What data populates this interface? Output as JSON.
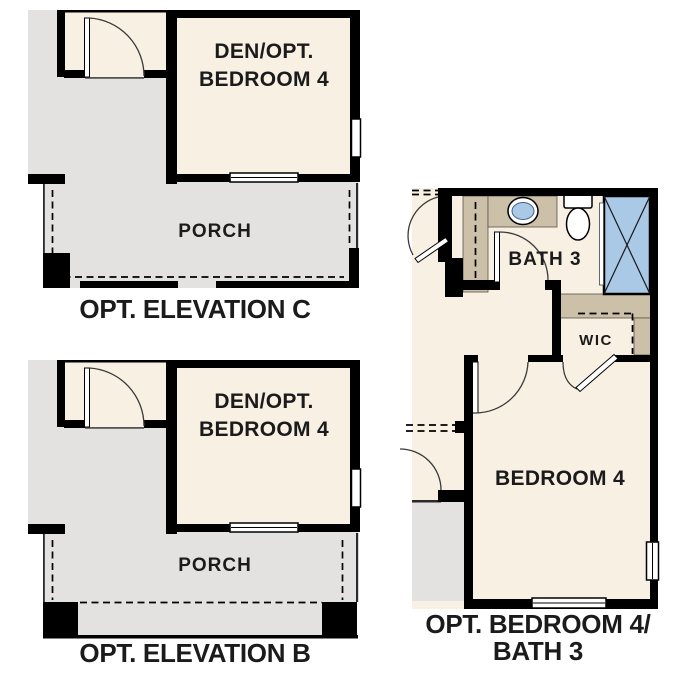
{
  "colors": {
    "background": "#ffffff",
    "beige": "#f7f0e3",
    "gray": "#e3e2e0",
    "tan": "#ccc1a8",
    "blue": "#a9c9e7",
    "wall": "#000000",
    "text": "#1b1b1b"
  },
  "plans": {
    "elevation_c": {
      "caption": "OPT. ELEVATION C",
      "room_line1": "DEN/OPT.",
      "room_line2": "BEDROOM 4",
      "porch": "PORCH"
    },
    "elevation_b": {
      "caption": "OPT. ELEVATION B",
      "room_line1": "DEN/OPT.",
      "room_line2": "BEDROOM 4",
      "porch": "PORCH"
    },
    "bedroom4_bath3": {
      "caption_line1": "OPT. BEDROOM 4/",
      "caption_line2": "BATH 3",
      "bath": "BATH 3",
      "wic": "WIC",
      "bedroom": "BEDROOM 4"
    }
  }
}
